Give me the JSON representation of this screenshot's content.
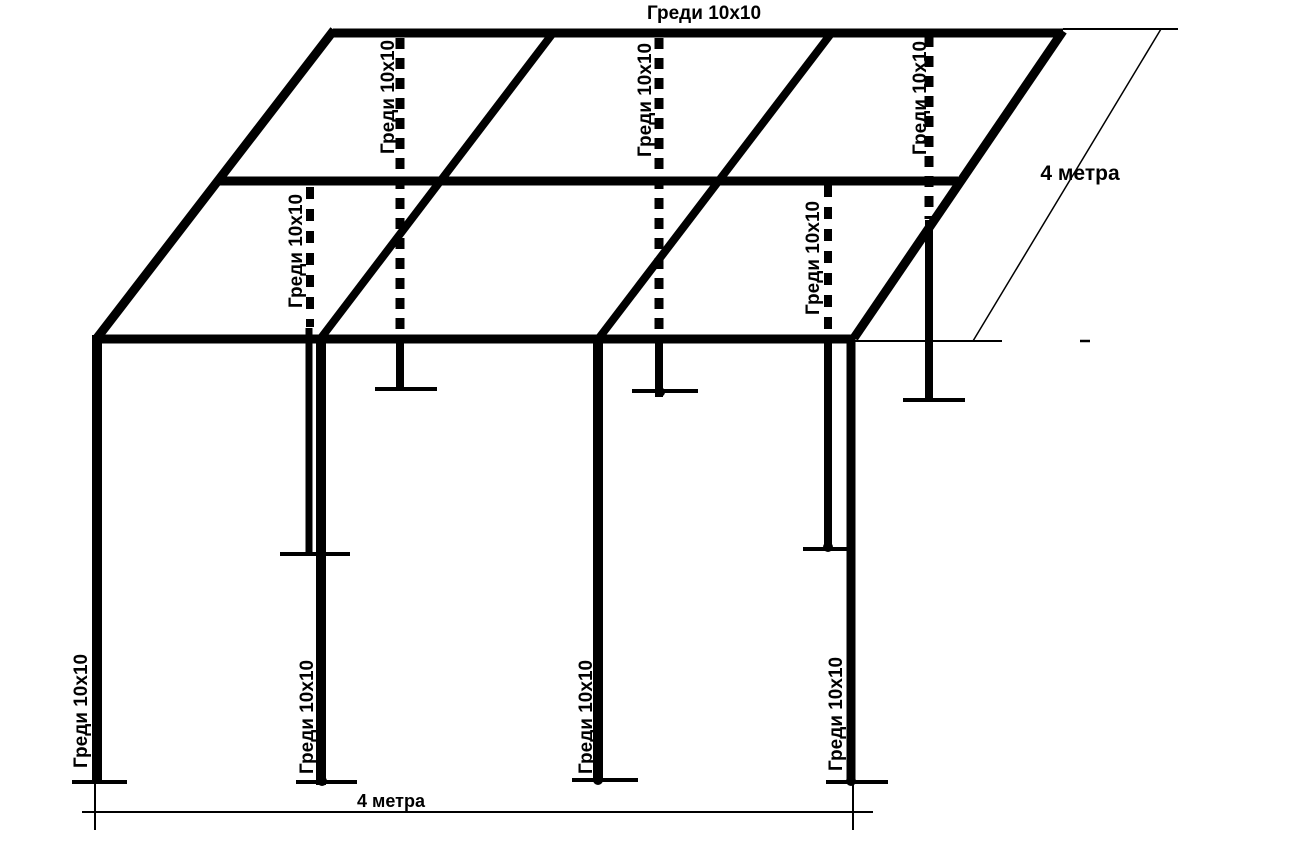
{
  "diagram": {
    "title": "Греди 10x10",
    "beam_label": "Греди 10x10",
    "dimension_depth": "4 метра",
    "dimension_width": "4 метра",
    "colors": {
      "line": "#000000",
      "background": "#ffffff"
    }
  }
}
